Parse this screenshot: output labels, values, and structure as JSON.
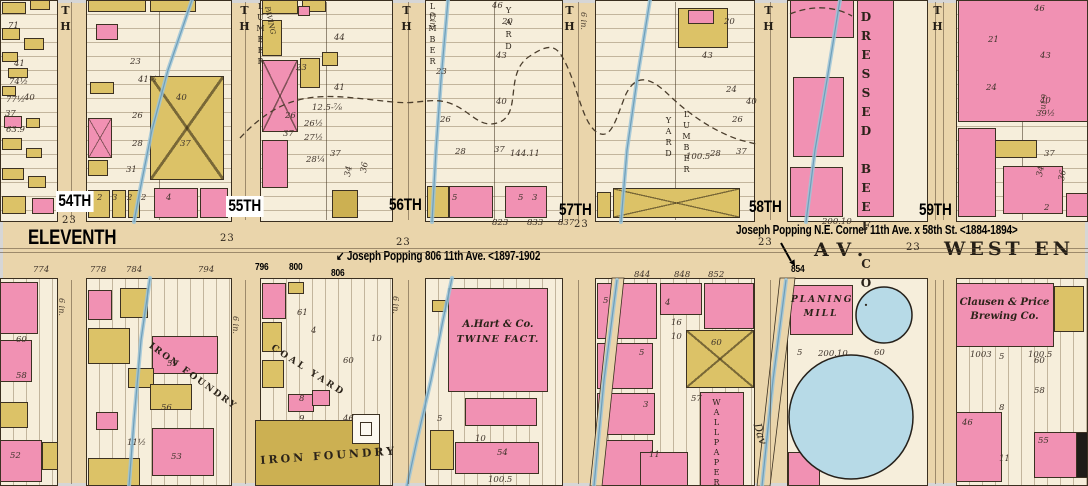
{
  "palette": {
    "street": "#ead5ab",
    "block": "#f6eedb",
    "pink": "#f191b3",
    "yellow": "#dcc267",
    "olive": "#ccb052",
    "blue": "#b7dae7",
    "stream": "#9cc4d8",
    "stream_dark": "#6f9fba",
    "ink": "#3a2f20",
    "annotation": "#000000",
    "frame_border": "#d6d6d6"
  },
  "avenue": {
    "eleventh": "ELEVENTH",
    "av": "AV.",
    "west_end": "WEST EN"
  },
  "businesses_static": {
    "gas_holder": "GAS HOLDER"
  },
  "annotations": {
    "popping_806": {
      "arrow": "↙ ",
      "text": "Joseph Popping 806 11th Ave. <1897-1902"
    },
    "popping_58th": {
      "text": "Joseph Popping N.E. Corner 11th Ave. x 58th St. <1884-1894>"
    }
  },
  "house_number_annotations": [
    [
      "796",
      255,
      262
    ],
    [
      "800",
      289,
      262
    ],
    [
      "806",
      331,
      268
    ],
    [
      "854",
      791,
      264
    ]
  ],
  "street_labels": [
    [
      "54TH",
      56,
      191,
      1
    ],
    [
      "55TH",
      226,
      196,
      1
    ],
    [
      "56TH",
      389,
      196,
      0
    ],
    [
      "57TH",
      559,
      201,
      0
    ],
    [
      "58TH",
      749,
      198,
      0
    ],
    [
      "59TH",
      919,
      201,
      0
    ]
  ],
  "street_top_glyphs": [
    {
      "t": "TH",
      "x": 60
    },
    {
      "t": "TH",
      "x": 239
    },
    {
      "t": "TH",
      "x": 401
    },
    {
      "t": "TH",
      "x": 564
    },
    {
      "t": "TH",
      "x": 763
    },
    {
      "t": "TH",
      "x": 932
    }
  ],
  "width_markers": [
    [
      "23",
      62,
      216
    ],
    [
      "23",
      220,
      234
    ],
    [
      "23",
      396,
      238
    ],
    [
      "23",
      574,
      220
    ],
    [
      "23",
      758,
      238
    ],
    [
      "23",
      906,
      243
    ]
  ],
  "pipe_labels": [
    [
      "6 in.",
      66,
      298
    ],
    [
      "6 in.",
      240,
      316
    ],
    [
      "6 in.",
      400,
      296
    ],
    [
      "6 in.",
      437,
      12
    ],
    [
      "6 in.",
      588,
      12
    ],
    [
      "6 in.",
      1048,
      94
    ]
  ],
  "blocks": [
    [
      0,
      0,
      58,
      222,
      "h"
    ],
    [
      86,
      0,
      146,
      222,
      "h"
    ],
    [
      260,
      0,
      133,
      222,
      "h"
    ],
    [
      425,
      0,
      138,
      222,
      "h"
    ],
    [
      595,
      0,
      160,
      222,
      "h"
    ],
    [
      787,
      0,
      141,
      222,
      ""
    ],
    [
      956,
      0,
      132,
      222,
      "h"
    ],
    [
      0,
      278,
      58,
      208,
      "v"
    ],
    [
      86,
      278,
      146,
      208,
      "v"
    ],
    [
      260,
      278,
      133,
      208,
      "v"
    ],
    [
      425,
      278,
      138,
      208,
      "v"
    ],
    [
      595,
      278,
      160,
      208,
      "v"
    ],
    [
      787,
      278,
      141,
      208,
      ""
    ],
    [
      956,
      278,
      132,
      208,
      "v"
    ]
  ],
  "dividers": [
    159,
    326,
    494,
    675,
    1022
  ],
  "center_lines": [
    [
      71,
      2,
      1,
      218
    ],
    [
      245,
      2,
      1,
      218
    ],
    [
      408,
      2,
      1,
      218
    ],
    [
      578,
      2,
      1,
      218
    ],
    [
      770,
      2,
      1,
      218
    ],
    [
      935,
      2,
      1,
      218
    ],
    [
      943,
      2,
      1,
      218
    ],
    [
      71,
      280,
      1,
      204
    ],
    [
      245,
      280,
      1,
      204
    ],
    [
      408,
      280,
      1,
      204
    ],
    [
      578,
      280,
      1,
      204
    ],
    [
      770,
      280,
      1,
      204
    ],
    [
      935,
      280,
      1,
      204
    ],
    [
      943,
      280,
      1,
      204
    ],
    [
      0,
      248,
      1088,
      1
    ],
    [
      0,
      252,
      1088,
      1
    ]
  ],
  "buildings": [
    [
      2,
      2,
      24,
      12,
      "y"
    ],
    [
      30,
      0,
      20,
      10,
      "y"
    ],
    [
      2,
      28,
      18,
      12,
      "y"
    ],
    [
      24,
      38,
      20,
      12,
      "y"
    ],
    [
      2,
      52,
      16,
      10,
      "y"
    ],
    [
      8,
      68,
      20,
      10,
      "y"
    ],
    [
      2,
      86,
      14,
      10,
      "y"
    ],
    [
      4,
      116,
      18,
      12,
      "p"
    ],
    [
      26,
      118,
      14,
      10,
      "y"
    ],
    [
      2,
      138,
      20,
      12,
      "y"
    ],
    [
      26,
      148,
      16,
      10,
      "y"
    ],
    [
      2,
      168,
      22,
      12,
      "y"
    ],
    [
      28,
      176,
      18,
      12,
      "y"
    ],
    [
      2,
      196,
      24,
      18,
      "y"
    ],
    [
      32,
      198,
      22,
      16,
      "p"
    ],
    [
      88,
      0,
      58,
      12,
      "y"
    ],
    [
      150,
      0,
      46,
      12,
      "y"
    ],
    [
      96,
      24,
      22,
      16,
      "p"
    ],
    [
      90,
      82,
      24,
      12,
      "y"
    ],
    [
      88,
      118,
      24,
      40,
      "p",
      "x"
    ],
    [
      88,
      160,
      20,
      16,
      "y"
    ],
    [
      150,
      76,
      74,
      104,
      "y",
      "x"
    ],
    [
      88,
      190,
      22,
      28,
      "y"
    ],
    [
      112,
      190,
      14,
      28,
      "y"
    ],
    [
      128,
      190,
      12,
      28,
      "y"
    ],
    [
      154,
      188,
      44,
      30,
      "p"
    ],
    [
      200,
      188,
      28,
      30,
      "p"
    ],
    [
      262,
      0,
      36,
      14,
      "y"
    ],
    [
      302,
      0,
      24,
      12,
      "y"
    ],
    [
      298,
      6,
      12,
      10,
      "p"
    ],
    [
      262,
      20,
      20,
      36,
      "y"
    ],
    [
      262,
      60,
      36,
      72,
      "p",
      "x"
    ],
    [
      300,
      58,
      20,
      30,
      "y"
    ],
    [
      322,
      52,
      16,
      14,
      "y"
    ],
    [
      262,
      140,
      26,
      48,
      "p"
    ],
    [
      332,
      190,
      26,
      28,
      "o"
    ],
    [
      427,
      186,
      22,
      32,
      "y"
    ],
    [
      449,
      186,
      44,
      32,
      "p"
    ],
    [
      505,
      186,
      42,
      32,
      "p"
    ],
    [
      678,
      8,
      50,
      40,
      "y"
    ],
    [
      688,
      10,
      26,
      14,
      "p"
    ],
    [
      613,
      188,
      127,
      30,
      "y",
      "x"
    ],
    [
      597,
      192,
      14,
      26,
      "y"
    ],
    [
      790,
      0,
      64,
      38,
      "p"
    ],
    [
      857,
      0,
      37,
      217,
      "p"
    ],
    [
      793,
      77,
      51,
      80,
      "p"
    ],
    [
      790,
      167,
      53,
      50,
      "p"
    ],
    [
      958,
      0,
      130,
      122,
      "p"
    ],
    [
      958,
      128,
      38,
      89,
      "p"
    ],
    [
      995,
      140,
      42,
      18,
      "y"
    ],
    [
      1003,
      166,
      60,
      48,
      "p"
    ],
    [
      1066,
      193,
      22,
      24,
      "p"
    ],
    [
      0,
      282,
      38,
      52,
      "p"
    ],
    [
      0,
      340,
      32,
      42,
      "p"
    ],
    [
      0,
      402,
      28,
      26,
      "y"
    ],
    [
      0,
      440,
      42,
      42,
      "p"
    ],
    [
      42,
      442,
      16,
      28,
      "y"
    ],
    [
      88,
      290,
      24,
      30,
      "p"
    ],
    [
      120,
      288,
      28,
      30,
      "y"
    ],
    [
      88,
      328,
      42,
      36,
      "y"
    ],
    [
      152,
      336,
      66,
      38,
      "p"
    ],
    [
      128,
      368,
      26,
      20,
      "y"
    ],
    [
      150,
      384,
      42,
      26,
      "y"
    ],
    [
      96,
      412,
      22,
      18,
      "p"
    ],
    [
      152,
      428,
      62,
      48,
      "p"
    ],
    [
      88,
      458,
      52,
      28,
      "y"
    ],
    [
      262,
      283,
      24,
      36,
      "p"
    ],
    [
      288,
      282,
      16,
      12,
      "y"
    ],
    [
      262,
      322,
      20,
      30,
      "y"
    ],
    [
      262,
      360,
      22,
      28,
      "y"
    ],
    [
      288,
      394,
      26,
      18,
      "p"
    ],
    [
      312,
      390,
      18,
      16,
      "p"
    ],
    [
      255,
      420,
      125,
      66,
      "o"
    ],
    [
      352,
      414,
      28,
      30,
      "w"
    ],
    [
      360,
      422,
      12,
      14,
      "w"
    ],
    [
      432,
      300,
      14,
      12,
      "y"
    ],
    [
      452,
      306,
      16,
      12,
      "y"
    ],
    [
      448,
      288,
      100,
      104,
      "p"
    ],
    [
      465,
      398,
      72,
      28,
      "p"
    ],
    [
      430,
      430,
      24,
      40,
      "y"
    ],
    [
      455,
      442,
      84,
      32,
      "p"
    ],
    [
      597,
      283,
      60,
      56,
      "p"
    ],
    [
      597,
      343,
      56,
      46,
      "p"
    ],
    [
      597,
      393,
      58,
      42,
      "p"
    ],
    [
      597,
      440,
      56,
      46,
      "p"
    ],
    [
      660,
      283,
      42,
      32,
      "p"
    ],
    [
      704,
      283,
      50,
      46,
      "p"
    ],
    [
      686,
      330,
      68,
      58,
      "y",
      "x"
    ],
    [
      700,
      392,
      44,
      94,
      "p"
    ],
    [
      640,
      452,
      48,
      34,
      "p"
    ],
    [
      790,
      285,
      63,
      50,
      "p"
    ],
    [
      788,
      452,
      32,
      34,
      "p"
    ],
    [
      956,
      283,
      98,
      64,
      "p"
    ],
    [
      1054,
      286,
      30,
      46,
      "y"
    ],
    [
      956,
      412,
      46,
      70,
      "p"
    ],
    [
      1034,
      432,
      50,
      46,
      "p"
    ],
    [
      1076,
      432,
      12,
      46,
      "k"
    ]
  ],
  "circles": [
    [
      851,
      417,
      62
    ],
    [
      884,
      315,
      28
    ]
  ],
  "strips": [
    "612,278 624,278 602,486 590,486",
    "780,278 795,278 770,486 757,486"
  ],
  "streams": [
    "192,0 168,70 152,130 140,190 134,222",
    "150,278 141,340 134,420 129,486",
    "448,0 441,80 436,150 432,222",
    "452,278 443,320 431,380 417,440 407,486",
    "650,0 637,80 627,150 621,222",
    "840,0 827,80 815,150 806,222",
    "617,280 604,380 594,486",
    "786,280 773,380 762,486"
  ],
  "dashed_paths": [
    "M240,138 C290,84 330,96 393,102 C420,105 432,96 452,104 C472,112 480,130 500,122 C522,112 504,72 530,56 C548,44 556,44 564,60 C578,86 582,124 598,133 C612,140 616,118 626,94 C638,70 654,80 672,98 C694,118 716,132 740,140 L756,144",
    "M790,14 C812,5 834,6 852,16"
  ],
  "arrow_58th": {
    "line": [
      781,
      243,
      791,
      261
    ],
    "head": "795,266 789.3,262.4 794.5,259.4"
  },
  "business_labels": [
    {
      "t": "DRESSED BEEF CO.",
      "x": 860,
      "y": 10,
      "vert": 1,
      "size": 12,
      "ls": 5,
      "b": 1
    },
    {
      "t": "PLANING",
      "x": 791,
      "y": 296,
      "w": 60,
      "size": 9,
      "i": 1,
      "ls": 2,
      "ctr": 1,
      "b": 1
    },
    {
      "t": "MILL",
      "x": 791,
      "y": 310,
      "w": 60,
      "size": 9,
      "i": 1,
      "ls": 2,
      "ctr": 1,
      "b": 1
    },
    {
      "t": "Clausen & Price",
      "x": 952,
      "y": 298,
      "w": 105,
      "size": 10,
      "i": 1,
      "ctr": 1,
      "b": 1
    },
    {
      "t": "Brewing Co.",
      "x": 952,
      "y": 312,
      "w": 105,
      "size": 10,
      "i": 1,
      "ctr": 1,
      "b": 1
    },
    {
      "t": "A.Hart & Co.",
      "x": 450,
      "y": 320,
      "w": 96,
      "size": 10,
      "i": 1,
      "ctr": 1,
      "b": 1
    },
    {
      "t": "TWINE FACT.",
      "x": 450,
      "y": 335,
      "w": 96,
      "size": 9.5,
      "i": 1,
      "ctr": 1,
      "ls": 1,
      "b": 1
    },
    {
      "t": "IRON FOUNDRY",
      "x": 152,
      "y": 342,
      "rot": 36,
      "size": 9,
      "ls": 2,
      "b": 1
    },
    {
      "t": "COAL YARD",
      "x": 274,
      "y": 344,
      "rot": 33,
      "size": 9,
      "ls": 3,
      "b": 1
    },
    {
      "t": "IRON FOUNDRY",
      "x": 260,
      "y": 455,
      "rot": -4,
      "size": 11,
      "ls": 3,
      "b": 1
    },
    {
      "t": "LUMBER",
      "x": 256,
      "y": 2,
      "vert": 1,
      "size": 8,
      "ls": 2
    },
    {
      "t": "PAVING",
      "x": 270,
      "y": 6,
      "rot": 78,
      "size": 7,
      "i": 1
    },
    {
      "t": "LUMBER",
      "x": 428,
      "y": 2,
      "vert": 1,
      "size": 8,
      "ls": 2
    },
    {
      "t": "YARD",
      "x": 504,
      "y": 6,
      "vert": 1,
      "size": 8,
      "ls": 3
    },
    {
      "t": "YARD",
      "x": 664,
      "y": 116,
      "vert": 1,
      "size": 8,
      "ls": 2
    },
    {
      "t": "LUMBER",
      "x": 682,
      "y": 110,
      "vert": 1,
      "size": 8,
      "ls": 2
    },
    {
      "t": "WALLPAPER",
      "x": 712,
      "y": 398,
      "vert": 1,
      "size": 8,
      "ls": 1
    },
    {
      "t": "Dav",
      "x": 762,
      "y": 422,
      "rot": 72,
      "size": 11,
      "i": 1
    }
  ],
  "lot_numbers": [
    [
      "71",
      8,
      22
    ],
    [
      "41",
      14,
      60
    ],
    [
      "74½",
      9,
      78
    ],
    [
      "77½",
      6,
      96
    ],
    [
      "37",
      5,
      110
    ],
    [
      "40",
      24,
      94
    ],
    [
      "63.9",
      6,
      126
    ],
    [
      "23",
      130,
      58
    ],
    [
      "41½",
      138,
      76
    ],
    [
      "40",
      176,
      94
    ],
    [
      "26",
      132,
      112
    ],
    [
      "28",
      132,
      140
    ],
    [
      "37",
      180,
      140
    ],
    [
      "31",
      126,
      166
    ],
    [
      "2",
      97,
      194
    ],
    [
      "3",
      112,
      194
    ],
    [
      "2",
      127,
      194
    ],
    [
      "2",
      141,
      194
    ],
    [
      "4",
      166,
      194
    ],
    [
      "44",
      334,
      34
    ],
    [
      "23",
      296,
      64
    ],
    [
      "41",
      334,
      84
    ],
    [
      "12.5-⅞",
      312,
      104
    ],
    [
      "26",
      285,
      112
    ],
    [
      "26½",
      304,
      120
    ],
    [
      "37",
      283,
      130
    ],
    [
      "27½",
      304,
      134
    ],
    [
      "28¼",
      306,
      156
    ],
    [
      "37",
      330,
      150
    ],
    [
      "34",
      344,
      176,
      -80
    ],
    [
      "36",
      360,
      172,
      -80
    ],
    [
      "46",
      492,
      2
    ],
    [
      "20",
      502,
      18
    ],
    [
      "43",
      496,
      52
    ],
    [
      "23",
      436,
      68
    ],
    [
      "40",
      496,
      98
    ],
    [
      "26",
      440,
      116
    ],
    [
      "28",
      455,
      148
    ],
    [
      "37",
      494,
      146
    ],
    [
      "144.11",
      510,
      150
    ],
    [
      "5",
      452,
      194
    ],
    [
      "5",
      518,
      194
    ],
    [
      "3",
      532,
      194
    ],
    [
      "20",
      724,
      18
    ],
    [
      "43",
      702,
      52
    ],
    [
      "24",
      726,
      86
    ],
    [
      "40",
      746,
      98
    ],
    [
      "26",
      732,
      116
    ],
    [
      "28",
      710,
      150
    ],
    [
      "37",
      736,
      148
    ],
    [
      "100.5",
      686,
      153
    ],
    [
      "200.10",
      822,
      218
    ],
    [
      "46",
      1034,
      5
    ],
    [
      "21",
      988,
      36
    ],
    [
      "43",
      1040,
      52
    ],
    [
      "24",
      986,
      84
    ],
    [
      "40",
      1040,
      97
    ],
    [
      "39½",
      1036,
      110
    ],
    [
      "37",
      1044,
      150
    ],
    [
      "34",
      1036,
      176,
      -80
    ],
    [
      "36",
      1058,
      180,
      -80
    ],
    [
      "2",
      1044,
      204
    ],
    [
      "823",
      492,
      219
    ],
    [
      "833",
      527,
      219
    ],
    [
      "837",
      558,
      219
    ],
    [
      "774",
      33,
      266
    ],
    [
      "778",
      90,
      266
    ],
    [
      "784",
      126,
      266
    ],
    [
      "794",
      198,
      266
    ],
    [
      "844",
      634,
      271
    ],
    [
      "848",
      674,
      271
    ],
    [
      "852",
      708,
      271
    ],
    [
      "60",
      16,
      336
    ],
    [
      "58",
      16,
      372
    ],
    [
      "52",
      10,
      452
    ],
    [
      "59",
      167,
      360
    ],
    [
      "56",
      161,
      404
    ],
    [
      "53",
      171,
      453
    ],
    [
      "11½",
      127,
      439
    ],
    [
      "61",
      297,
      309
    ],
    [
      "4",
      311,
      327
    ],
    [
      "10",
      371,
      335
    ],
    [
      "60",
      343,
      357
    ],
    [
      "8",
      299,
      395
    ],
    [
      "9",
      299,
      415
    ],
    [
      "46",
      343,
      415
    ],
    [
      "54",
      497,
      449
    ],
    [
      "10",
      475,
      435
    ],
    [
      "100.5",
      488,
      476
    ],
    [
      "5",
      437,
      415
    ],
    [
      "5",
      603,
      297
    ],
    [
      "4",
      665,
      299
    ],
    [
      "16",
      671,
      319
    ],
    [
      "10",
      671,
      333
    ],
    [
      "5",
      639,
      349
    ],
    [
      "3",
      643,
      401
    ],
    [
      "11",
      649,
      451
    ],
    [
      "60",
      711,
      339
    ],
    [
      "57",
      691,
      395
    ],
    [
      "5",
      797,
      349
    ],
    [
      "200.10",
      818,
      350
    ],
    [
      "60",
      874,
      349
    ],
    [
      "1003",
      970,
      351
    ],
    [
      "5",
      999,
      353
    ],
    [
      "100.5",
      1028,
      351
    ],
    [
      "60",
      1034,
      357
    ],
    [
      "58",
      1034,
      387
    ],
    [
      "8",
      999,
      404
    ],
    [
      "46",
      962,
      419
    ],
    [
      "55",
      1038,
      437
    ],
    [
      "11",
      999,
      455
    ]
  ]
}
